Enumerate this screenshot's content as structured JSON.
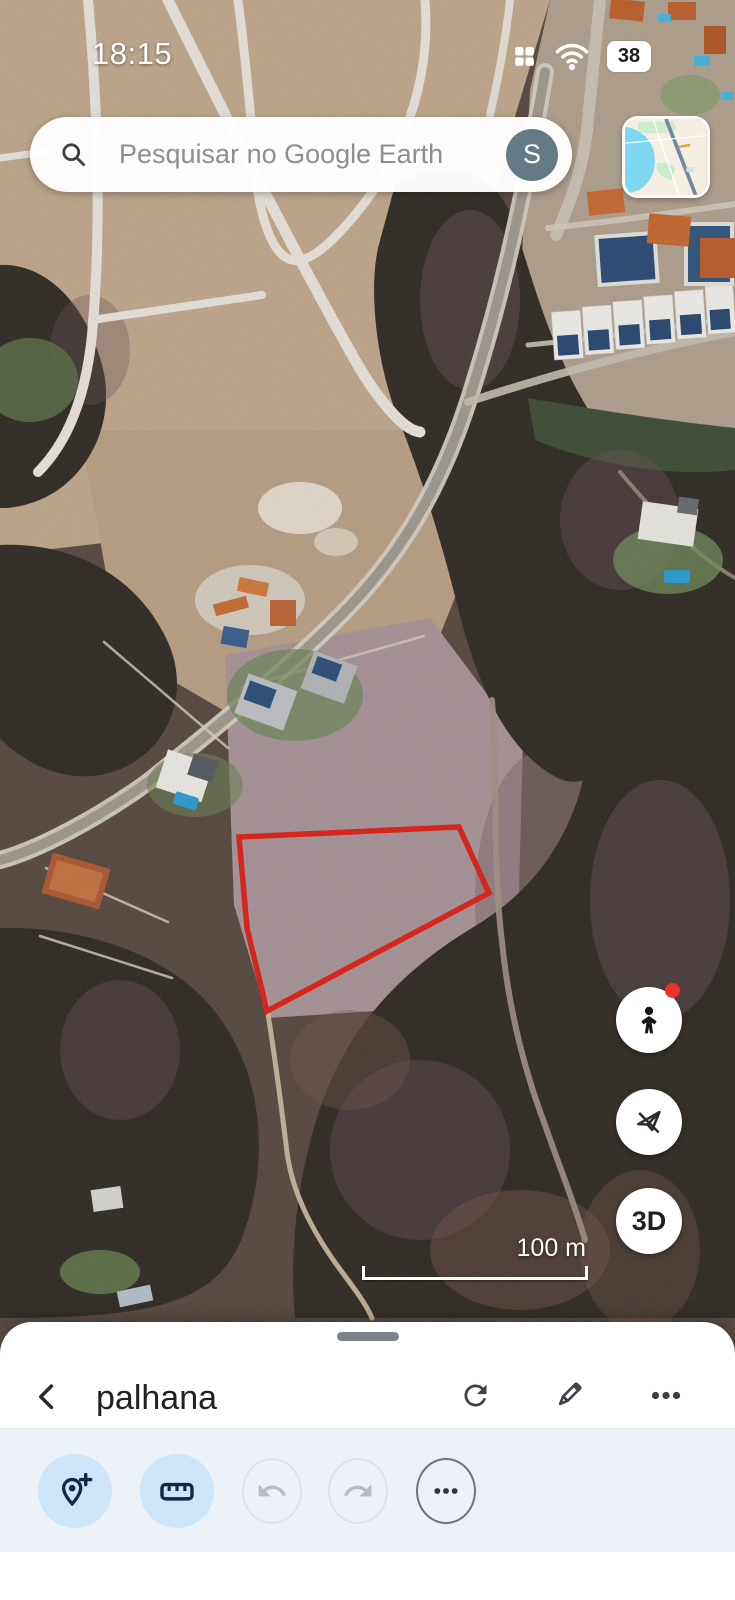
{
  "status_bar": {
    "time": "18:15",
    "battery_percent": "38"
  },
  "search_bar": {
    "placeholder": "Pesquisar no Google Earth",
    "avatar_letter": "S"
  },
  "map": {
    "scale_label": "100 m",
    "parcel_outline_color": "#e02419",
    "view_3d_label": "3D"
  },
  "bottom_sheet": {
    "title": "palhana"
  },
  "icons": {
    "status": [
      "apps-grid",
      "wifi",
      "battery"
    ],
    "search": "magnifier",
    "map_buttons": [
      "street-view-pegman",
      "flight-disabled",
      "3d"
    ],
    "sheet_header": [
      "back-chevron",
      "refresh",
      "edit-pencil",
      "more-dots"
    ],
    "toolbar": [
      "add-placemark",
      "measure-ruler",
      "undo",
      "redo",
      "overflow-dots"
    ]
  },
  "colors": {
    "toolbar_button_blue": "#cde5f9",
    "toolbar_bg": "#edf1f8",
    "avatar_bg": "#647a85",
    "notification_red": "#e8352a"
  }
}
